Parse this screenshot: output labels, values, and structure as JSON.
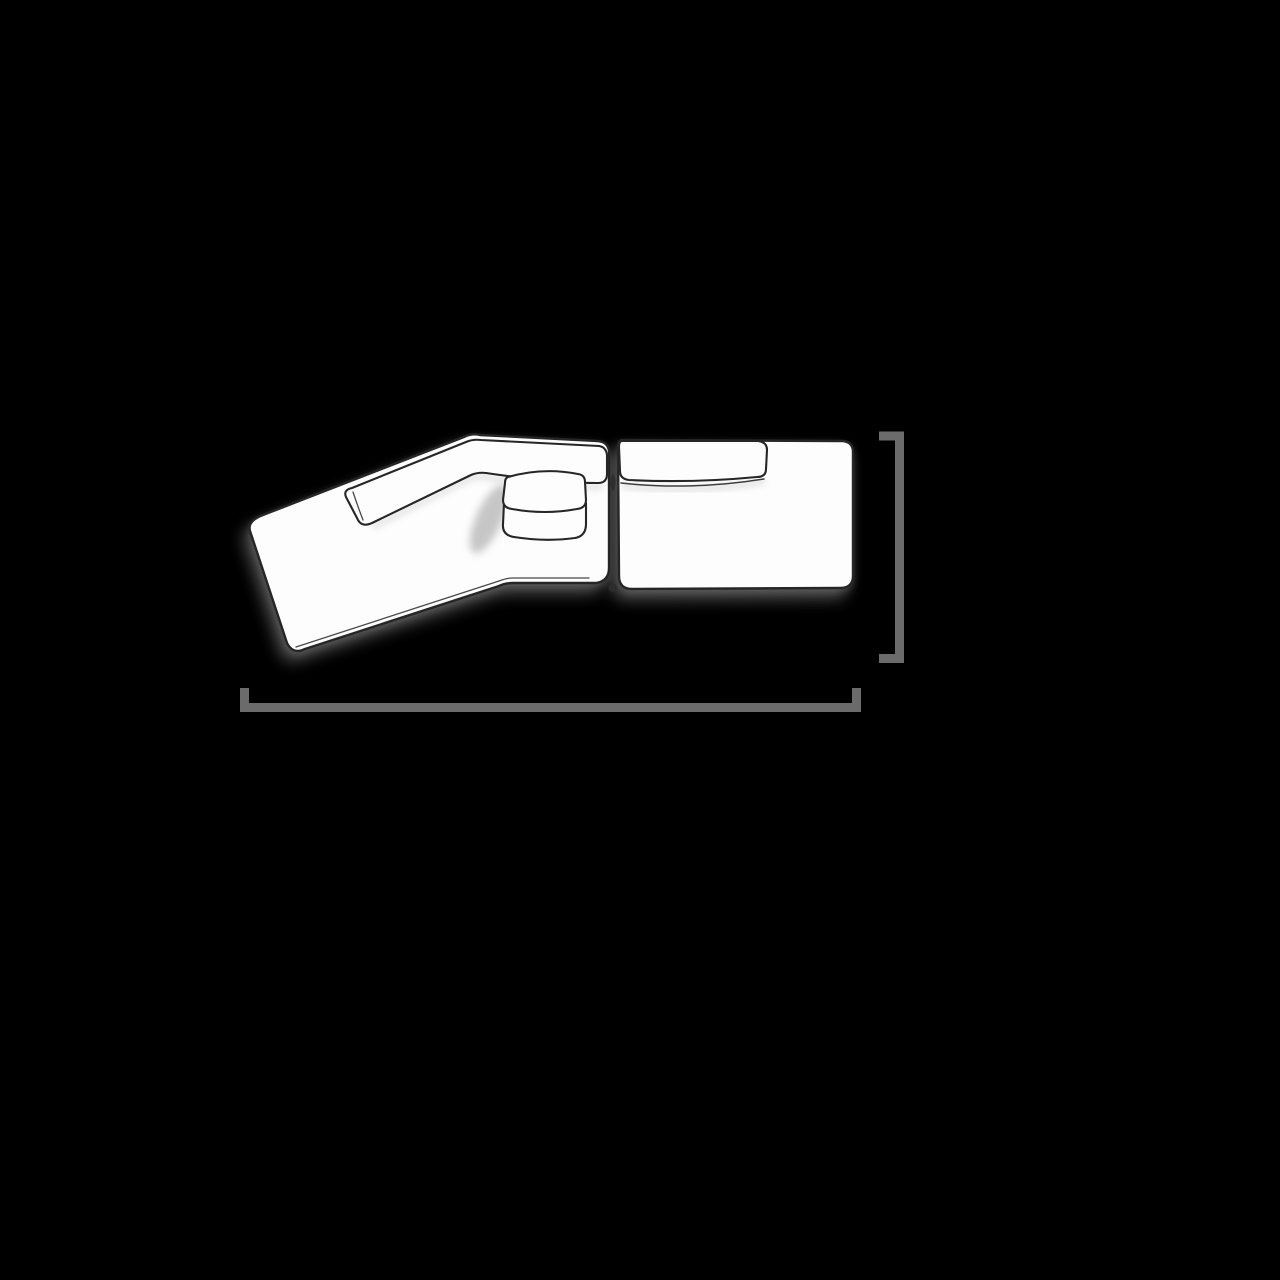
{
  "figure": {
    "type": "product-dimension-diagram",
    "subject": "three-piece modular sectional sofa, top view, angled chaise on left",
    "components": [
      "angled-chaise-seat",
      "chaise-backrest-cushion",
      "folded-lumbar-pillow",
      "right-seat-module",
      "right-backrest-cushion"
    ],
    "dimension_markers": [
      {
        "id": "overall-width",
        "orientation": "horizontal",
        "position": "below-sofa",
        "style": "bracket-with-end-ticks"
      },
      {
        "id": "overall-depth",
        "orientation": "vertical",
        "position": "right-of-sofa",
        "style": "bracket-with-end-ticks"
      }
    ]
  },
  "colors": {
    "bg": "#000000",
    "fill": "#fdfdfd",
    "line": "#262626",
    "line-soft": "#4a4a4a",
    "dim-line": "#6b6b6b",
    "shadow": "#6a6a6a",
    "shading": "#cfcfcf"
  }
}
